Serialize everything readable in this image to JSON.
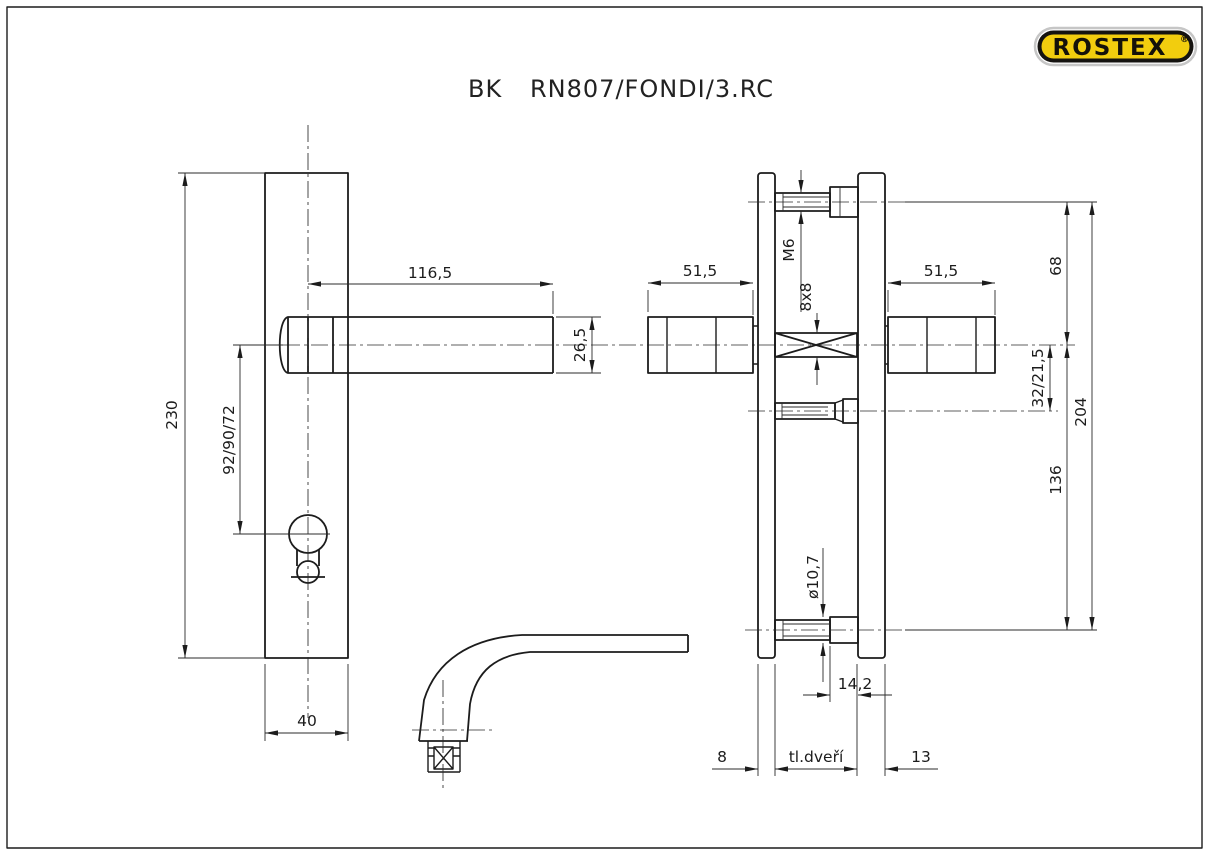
{
  "drawing": {
    "title_prefix": "BK",
    "title_main": "RN807/FONDI/3.RC",
    "brand": {
      "name": "ROSTEX",
      "registered": "®",
      "colors": {
        "badge_fill": "#f2cd0e",
        "badge_ring": "#151310",
        "badge_outer": "#c6c6c6",
        "line": "#1c1c1c",
        "background": "#ffffff"
      }
    },
    "front_view": {
      "dims": {
        "plate_height": "230",
        "axis_spacing": "92/90/72",
        "handle_length": "116,5",
        "handle_thickness": "26,5",
        "plate_width": "40"
      }
    },
    "side_view": {
      "dims": {
        "handle_depth_left": "51,5",
        "handle_depth_right": "51,5",
        "screw_thread": "M6",
        "spindle_size": "8x8",
        "top_screw_offset": "68",
        "mid_screw_offset": "32/21,5",
        "screw_span": "204",
        "bottom_screw_offset": "136",
        "screw_head_dia": "ø10,7",
        "screw_head_len": "14,2",
        "outer_plate_thickness": "8",
        "door_thickness_label": "tl.dveří",
        "inner_plate_thickness": "13"
      }
    }
  }
}
